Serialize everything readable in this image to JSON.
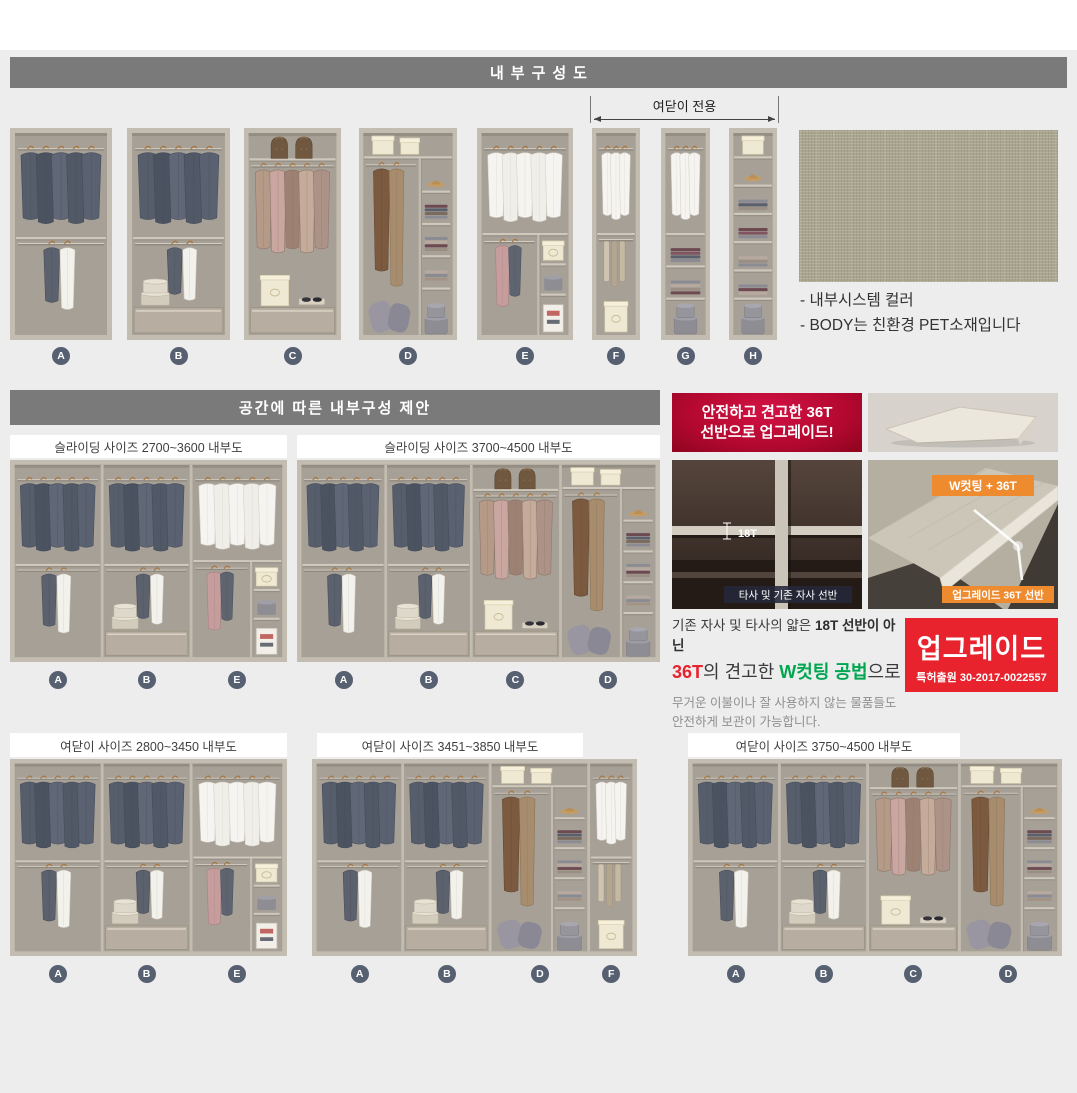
{
  "colors": {
    "accent_red": "#e8232e",
    "badge_orange": "#ef8b2f",
    "green": "#00a650",
    "header_gray": "#7a7a7a",
    "circle_slate": "#566070"
  },
  "section1": {
    "title": "내부구성도",
    "arrow_label": "여닫이 전용",
    "wardrobes": [
      {
        "label": "A",
        "type": "A"
      },
      {
        "label": "B",
        "type": "B"
      },
      {
        "label": "C",
        "type": "C"
      },
      {
        "label": "D",
        "type": "D"
      },
      {
        "label": "E",
        "type": "E"
      },
      {
        "label": "F",
        "type": "F"
      },
      {
        "label": "G",
        "type": "G"
      },
      {
        "label": "H",
        "type": "H"
      }
    ],
    "swatch_notes": [
      "- 내부시스템 컬러",
      "- BODY는 친환경 PET소재입니다"
    ]
  },
  "section2": {
    "title": "공간에 따른 내부구성 제안",
    "panels": [
      {
        "title": "슬라이딩 사이즈 2700~3600 내부도",
        "modules": [
          "A",
          "B",
          "E"
        ]
      },
      {
        "title": "슬라이딩 사이즈 3700~4500 내부도",
        "modules": [
          "A",
          "B",
          "C",
          "D"
        ]
      }
    ]
  },
  "upgrade": {
    "banner_line1": "안전하고 견고한 36T",
    "banner_line2": "선반으로 업그레이드!",
    "old_shelf": {
      "thickness": "18T",
      "caption": "타사 및 기존 자사 선반"
    },
    "new_shelf": {
      "badge": "W컷팅 + 36T",
      "caption": "업그레이드 36T 선반"
    },
    "desc1_normal": "기존 자사 및 타사의 얇은 ",
    "desc1_bold": "18T 선반이 아닌",
    "desc2_red": "36T",
    "desc2_mid": "의 견고한 ",
    "desc2_green": "W컷팅 공법",
    "desc2_tail": "으로",
    "desc_small1": "무거운 이불이나 잘 사용하지 않는 물품들도",
    "desc_small2": "안전하게 보관이 가능합니다.",
    "stamp_title": "업그레이드",
    "stamp_sub": "특허출원 30-2017-0022557"
  },
  "section3": {
    "panels": [
      {
        "title": "여닫이 사이즈 2800~3450 내부도",
        "modules": [
          "A",
          "B",
          "E"
        ]
      },
      {
        "title": "여닫이 사이즈 3451~3850 내부도",
        "modules": [
          "A",
          "B",
          "D",
          "F"
        ]
      },
      {
        "title": "여닫이 사이즈 3750~4500 내부도",
        "modules": [
          "A",
          "B",
          "C",
          "D"
        ]
      }
    ]
  }
}
